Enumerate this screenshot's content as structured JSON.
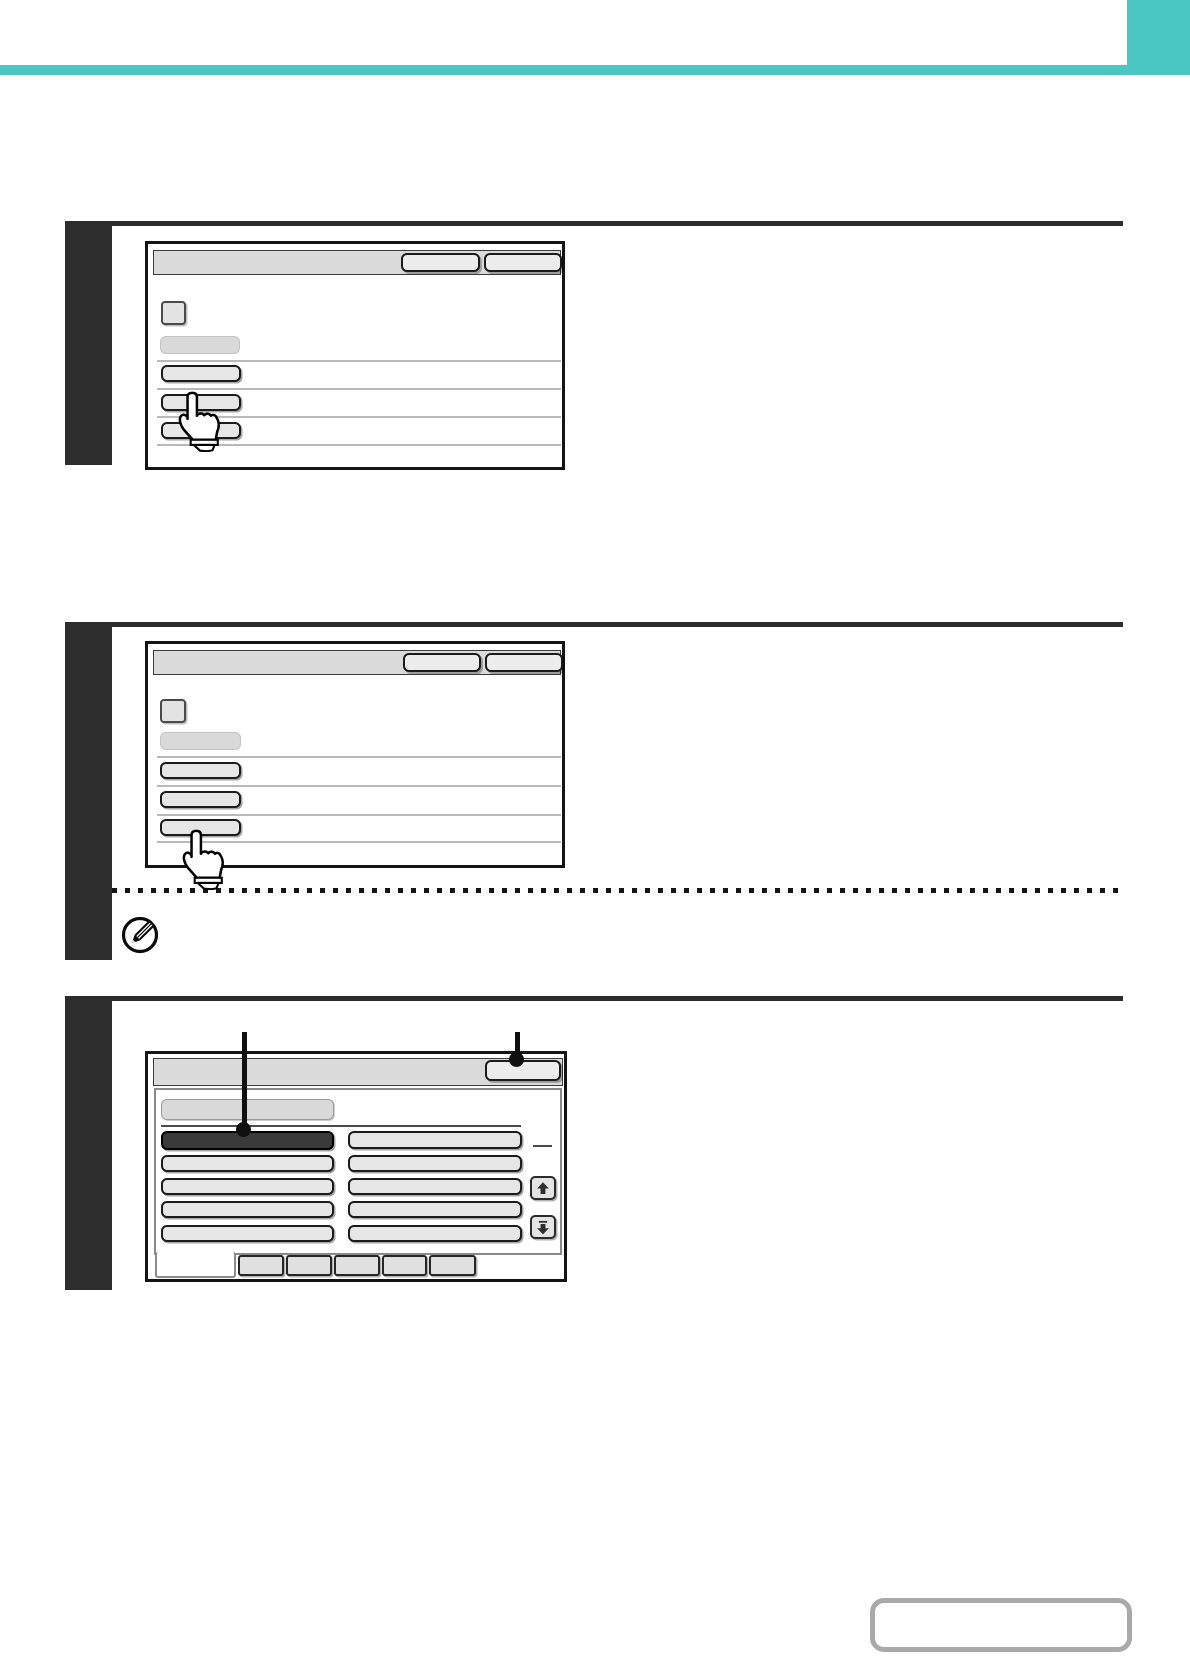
{
  "document": {
    "kind": "operation-manual-step-page",
    "visible_text": "",
    "accent_color": "#4AC7C3",
    "ink_color": "#2D2D2D"
  },
  "header": {
    "accent_bar": "",
    "corner_block": ""
  },
  "steps": [
    {
      "index": 1,
      "screen": {
        "titlebar_buttons": [
          "",
          ""
        ],
        "checkbox_label": "",
        "label_chip": "",
        "menu_buttons": [
          "",
          "",
          ""
        ],
        "hand_points_at_button": 2
      }
    },
    {
      "index": 2,
      "screen": {
        "titlebar_buttons": [
          "",
          ""
        ],
        "checkbox_label": "",
        "label_chip": "",
        "menu_buttons": [
          "",
          "",
          ""
        ],
        "hand_points_at_button": 3
      },
      "note": {
        "icon": "pencil-note-icon",
        "divider_style": "dashed",
        "text": ""
      }
    },
    {
      "index": 3,
      "callouts": [
        {
          "target": "selected-grid-button",
          "label": ""
        },
        {
          "target": "titlebar-button",
          "label": ""
        }
      ],
      "screen": {
        "titlebar_buttons": [
          ""
        ],
        "group_chip": "",
        "grid": {
          "columns": 2,
          "rows": 5,
          "selected_cell": {
            "row": 1,
            "col": 1
          },
          "button_labels": [
            "",
            "",
            "",
            "",
            "",
            "",
            "",
            "",
            "",
            ""
          ]
        },
        "scroll_buttons": [
          "up",
          "down"
        ],
        "page_indicator": "",
        "tabs": {
          "active_index": 1,
          "labels": [
            "",
            "",
            "",
            "",
            "",
            ""
          ]
        }
      }
    }
  ],
  "footer": {
    "page_number_box": ""
  }
}
